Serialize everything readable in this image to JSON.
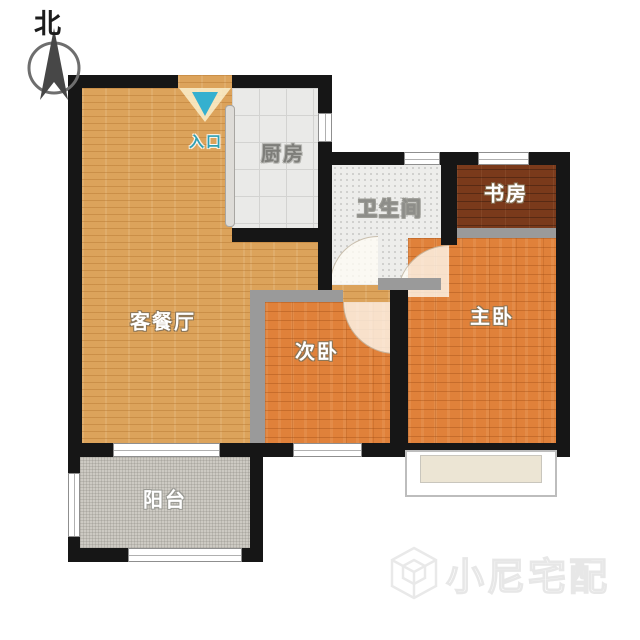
{
  "compass": {
    "label": "北"
  },
  "rooms": {
    "living": {
      "label": "客餐厅"
    },
    "kitchen": {
      "label": "厨房"
    },
    "bathroom": {
      "label": "卫生间"
    },
    "study": {
      "label": "书房"
    },
    "master": {
      "label": "主卧"
    },
    "secondary": {
      "label": "次卧"
    },
    "balcony": {
      "label": "阳台"
    }
  },
  "entrance": {
    "label": "入口"
  },
  "watermark": {
    "text": "小尼宅配"
  },
  "colors": {
    "wall": "#161616",
    "partition": "#9a9a9a",
    "living_floor": "#dca35b",
    "bedroom_floor": "#e0813a",
    "study_floor": "#7a3a1b",
    "kitchen_floor": "#eaeae8",
    "bathroom_floor": "#ededeb",
    "balcony_floor": "#cdcac3",
    "entrance_marker": "#35b0cf"
  }
}
